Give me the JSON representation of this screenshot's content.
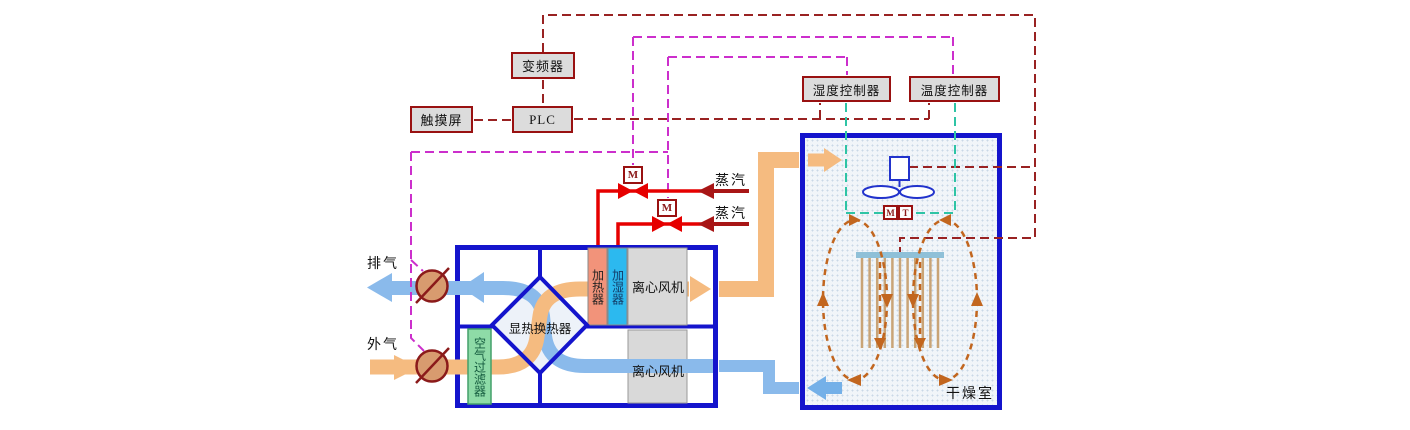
{
  "controls": {
    "vfd_label": "变频器",
    "touchscreen_label": "触摸屏",
    "plc_label": "PLC",
    "humidity_controller_label": "湿度控制器",
    "temperature_controller_label": "温度控制器"
  },
  "ahu": {
    "heat_exchanger_label": "显热换热器",
    "air_filter_label": "空气过滤器",
    "heater_label": "加热器",
    "humidifier_label": "加湿器",
    "fan_top_label": "离心风机",
    "fan_bottom_label": "离心风机"
  },
  "drying_room": {
    "label": "干燥室",
    "sensor_m_label": "M",
    "sensor_t_label": "T"
  },
  "flows": {
    "exhaust_label": "排气",
    "outside_air_label": "外气",
    "steam1_label": "蒸汽",
    "steam2_label": "蒸汽"
  },
  "valves": {
    "valve1_label": "M",
    "valve2_label": "M"
  },
  "icons": {
    "fan": "axial-fan-symbol",
    "valve": "motorized-steam-valve-symbol",
    "damper": "air-damper-symbol",
    "heat_exchanger": "cross-flow-plate-exchanger-diamond"
  },
  "colors": {
    "box_border_blue": "#1414CC",
    "control_border_red": "#991111",
    "control_fill": "#DCDCDC",
    "signal_dark_red": "#992222",
    "signal_magenta": "#CC2FCC",
    "signal_teal": "#2EC4A5",
    "steam_pipe_red": "#E60000",
    "steam_arrow_dark_red": "#A81616",
    "flow_orange": "#F5BB80",
    "flow_blue": "#8ABAEB",
    "loop_orange": "#C2661F",
    "heater_fill": "#F2937A",
    "humidifier_fill": "#2CB9EF",
    "filter_fill": "#8EDBA7",
    "fan_box_fill": "#D9D9D9",
    "damper_fill": "#D89B6F",
    "heater_bar_fill": "#8FC0D8",
    "rod_color": "#C9A477"
  }
}
